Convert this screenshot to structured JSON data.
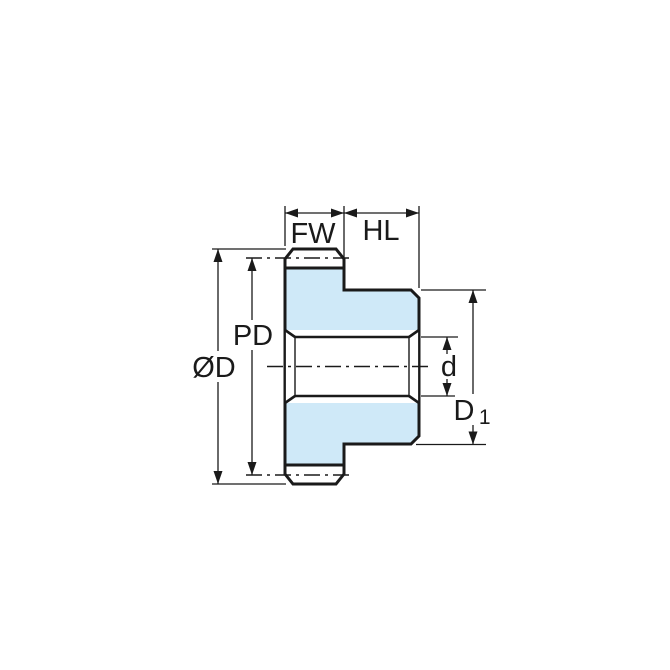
{
  "drawing": {
    "type": "technical-dimension-drawing",
    "subject": "spur gear cross-section with hub",
    "colors": {
      "part_fill": "#cfe9f8",
      "line": "#1a1a1a",
      "background": "#ffffff"
    },
    "labels": {
      "face_width": "FW",
      "hub_length": "HL",
      "pitch_diameter": "PD",
      "outer_diameter": "ØD",
      "bore_diameter": "d",
      "hub_diameter": {
        "base": "D",
        "sub": "1"
      }
    }
  }
}
